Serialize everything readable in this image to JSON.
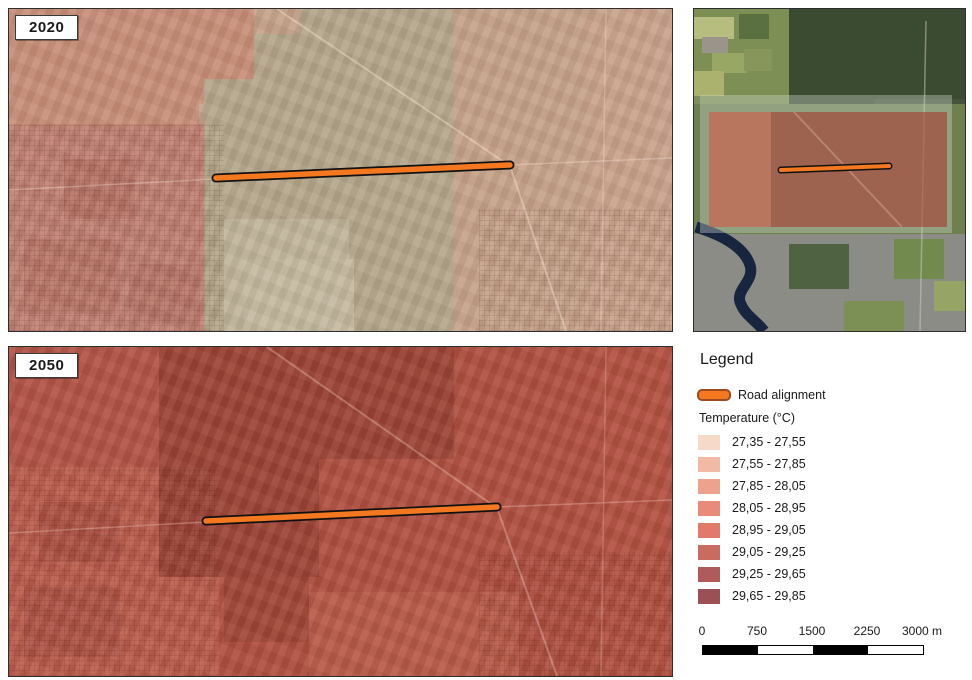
{
  "maps": {
    "map2020": {
      "label": "2020"
    },
    "map2050": {
      "label": "2050"
    }
  },
  "legend": {
    "title": "Legend",
    "road_label": "Road alignment",
    "road_color": "#f4781f",
    "road_outline": "#9c4a20",
    "temperature_label": "Temperature (°C)",
    "classes": [
      {
        "range": "27,35 - 27,55",
        "color": "#f7d9c7"
      },
      {
        "range": "27,55 - 27,85",
        "color": "#f2b9a5"
      },
      {
        "range": "27,85 - 28,05",
        "color": "#eda28e"
      },
      {
        "range": "28,05 - 28,95",
        "color": "#e88b78"
      },
      {
        "range": "28,95 - 29,05",
        "color": "#e07a6a"
      },
      {
        "range": "29,05 - 29,25",
        "color": "#c96b61"
      },
      {
        "range": "29,25 - 29,65",
        "color": "#af5b5b"
      },
      {
        "range": "29,65 - 29,85",
        "color": "#9a5054"
      }
    ]
  },
  "scalebar": {
    "labels": [
      "0",
      "750",
      "1500",
      "2250",
      "3000 m"
    ]
  }
}
